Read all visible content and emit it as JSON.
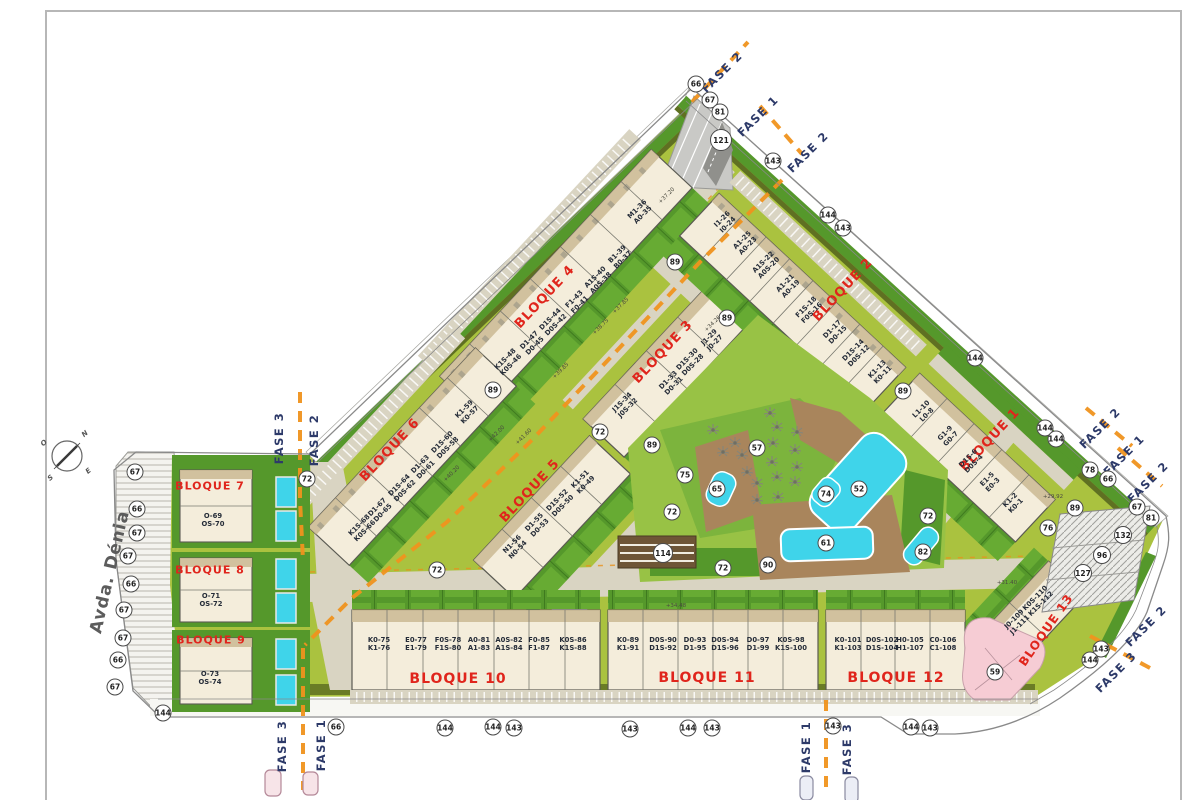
{
  "street": {
    "label": "Avda. Dénia"
  },
  "compass": {
    "n": "N",
    "o": "O",
    "s": "S",
    "e": "E"
  },
  "colors": {
    "block_red": "#e0251c",
    "fase_navy": "#2d3a69",
    "phase_orange": "#f0931e",
    "site_green": "#aac23f",
    "lawn_dark": "#55982b",
    "pool_cyan": "#3fd4ea",
    "building_cream": "#f4eddb",
    "deck_brown": "#a9855c",
    "pink_zone": "#f6ccd4"
  },
  "blocks": [
    {
      "label": "BLOQUE 1",
      "x": 990,
      "y": 440,
      "rot": -47,
      "fs": 13
    },
    {
      "label": "BLOQUE 2",
      "x": 843,
      "y": 290,
      "rot": -47,
      "fs": 13
    },
    {
      "label": "BLOQUE 3",
      "x": 663,
      "y": 352,
      "rot": -47,
      "fs": 13
    },
    {
      "label": "BLOQUE 4",
      "x": 545,
      "y": 297,
      "rot": -47,
      "fs": 13
    },
    {
      "label": "BLOQUE 5",
      "x": 530,
      "y": 491,
      "rot": -47,
      "fs": 13
    },
    {
      "label": "BLOQUE 6",
      "x": 390,
      "y": 450,
      "rot": -47,
      "fs": 13
    },
    {
      "label": "BLOQUE 7",
      "x": 210,
      "y": 486,
      "rot": 0,
      "fs": 11
    },
    {
      "label": "BLOQUE 8",
      "x": 210,
      "y": 570,
      "rot": 0,
      "fs": 11
    },
    {
      "label": "BLOQUE 9",
      "x": 211,
      "y": 640,
      "rot": 0,
      "fs": 11
    },
    {
      "label": "BLOQUE 10",
      "x": 458,
      "y": 679,
      "rot": 0,
      "fs": 14
    },
    {
      "label": "BLOQUE 11",
      "x": 707,
      "y": 678,
      "rot": 0,
      "fs": 14
    },
    {
      "label": "BLOQUE 12",
      "x": 896,
      "y": 678,
      "rot": 0,
      "fs": 14
    },
    {
      "label": "BLOQUE 13",
      "x": 1046,
      "y": 630,
      "rot": -55,
      "fs": 12
    }
  ],
  "units": [
    {
      "l1": "K1-2",
      "l2": "K0-1",
      "x": 1013,
      "y": 503,
      "rot": -45
    },
    {
      "l1": "E1-5",
      "l2": "E0-3",
      "x": 990,
      "y": 482,
      "rot": -45
    },
    {
      "l1": "D1S-6",
      "l2": "D0S-4",
      "x": 971,
      "y": 461,
      "rot": -45
    },
    {
      "l1": "G1-9",
      "l2": "G0-7",
      "x": 948,
      "y": 436,
      "rot": -45
    },
    {
      "l1": "L1-10",
      "l2": "L0-8",
      "x": 924,
      "y": 412,
      "rot": -45
    },
    {
      "l1": "K1-13",
      "l2": "K0-11",
      "x": 880,
      "y": 372,
      "rot": -45
    },
    {
      "l1": "D1S-14",
      "l2": "D0S-12",
      "x": 856,
      "y": 353,
      "rot": -45
    },
    {
      "l1": "D1-17",
      "l2": "D0-15",
      "x": 835,
      "y": 332,
      "rot": -45
    },
    {
      "l1": "F1S-18",
      "l2": "F0S-16",
      "x": 809,
      "y": 310,
      "rot": -45
    },
    {
      "l1": "A1-21",
      "l2": "A0-19",
      "x": 788,
      "y": 286,
      "rot": -45
    },
    {
      "l1": "A1S-22",
      "l2": "A0S-20",
      "x": 766,
      "y": 265,
      "rot": -45
    },
    {
      "l1": "A1-25",
      "l2": "A0-23",
      "x": 745,
      "y": 243,
      "rot": -45
    },
    {
      "l1": "I1-26",
      "l2": "I0-24",
      "x": 725,
      "y": 222,
      "rot": -45
    },
    {
      "l1": "J1S-34",
      "l2": "J0S-32",
      "x": 625,
      "y": 405,
      "rot": -45
    },
    {
      "l1": "D1-33",
      "l2": "D0-31",
      "x": 671,
      "y": 383,
      "rot": -45
    },
    {
      "l1": "D1S-30",
      "l2": "D0S-28",
      "x": 690,
      "y": 362,
      "rot": -45
    },
    {
      "l1": "J1-29",
      "l2": "J0-27",
      "x": 712,
      "y": 340,
      "rot": -45
    },
    {
      "l1": "K1S-48",
      "l2": "K0S-46",
      "x": 508,
      "y": 362,
      "rot": -45
    },
    {
      "l1": "D1-47",
      "l2": "D0-45",
      "x": 532,
      "y": 343,
      "rot": -45
    },
    {
      "l1": "D1S-44",
      "l2": "D0S-42",
      "x": 553,
      "y": 322,
      "rot": -45
    },
    {
      "l1": "F1-43",
      "l2": "F0-41",
      "x": 577,
      "y": 302,
      "rot": -45
    },
    {
      "l1": "A1S-40",
      "l2": "A0S-38",
      "x": 598,
      "y": 280,
      "rot": -45
    },
    {
      "l1": "B1-39",
      "l2": "B0-37",
      "x": 620,
      "y": 257,
      "rot": -45
    },
    {
      "l1": "M1-36",
      "l2": "A0-35",
      "x": 640,
      "y": 212,
      "rot": -45
    },
    {
      "l1": "N1-56",
      "l2": "N0-54",
      "x": 515,
      "y": 547,
      "rot": -45
    },
    {
      "l1": "D1-55",
      "l2": "D0-53",
      "x": 537,
      "y": 525,
      "rot": -45
    },
    {
      "l1": "D1S-52",
      "l2": "D0S-50",
      "x": 560,
      "y": 503,
      "rot": -45
    },
    {
      "l1": "K1-51",
      "l2": "K0-49",
      "x": 583,
      "y": 482,
      "rot": -45
    },
    {
      "l1": "K1S-68",
      "l2": "K0S-66",
      "x": 362,
      "y": 528,
      "rot": -45
    },
    {
      "l1": "D1-67",
      "l2": "D0-65",
      "x": 380,
      "y": 510,
      "rot": -45
    },
    {
      "l1": "D1S-64",
      "l2": "D0S-62",
      "x": 402,
      "y": 488,
      "rot": -45
    },
    {
      "l1": "D1-63",
      "l2": "D0-61",
      "x": 423,
      "y": 467,
      "rot": -45
    },
    {
      "l1": "D1S-60",
      "l2": "D0S-58",
      "x": 445,
      "y": 445,
      "rot": -45
    },
    {
      "l1": "K1-59",
      "l2": "K0-57",
      "x": 467,
      "y": 412,
      "rot": -45
    },
    {
      "l1": "O-69",
      "l2": "OS-70",
      "x": 213,
      "y": 520,
      "rot": 0
    },
    {
      "l1": "O-71",
      "l2": "OS-72",
      "x": 211,
      "y": 600,
      "rot": 0
    },
    {
      "l1": "O-73",
      "l2": "OS-74",
      "x": 210,
      "y": 678,
      "rot": 0
    },
    {
      "l1": "K0-75",
      "l2": "K1-76",
      "x": 379,
      "y": 644,
      "rot": 0
    },
    {
      "l1": "E0-77",
      "l2": "E1-79",
      "x": 416,
      "y": 644,
      "rot": 0
    },
    {
      "l1": "F0S-78",
      "l2": "F1S-80",
      "x": 448,
      "y": 644,
      "rot": 0
    },
    {
      "l1": "A0-81",
      "l2": "A1-83",
      "x": 479,
      "y": 644,
      "rot": 0
    },
    {
      "l1": "A0S-82",
      "l2": "A1S-84",
      "x": 509,
      "y": 644,
      "rot": 0
    },
    {
      "l1": "F0-85",
      "l2": "F1-87",
      "x": 539,
      "y": 644,
      "rot": 0
    },
    {
      "l1": "K0S-86",
      "l2": "K1S-88",
      "x": 573,
      "y": 644,
      "rot": 0
    },
    {
      "l1": "K0-89",
      "l2": "K1-91",
      "x": 628,
      "y": 644,
      "rot": 0
    },
    {
      "l1": "D0S-90",
      "l2": "D1S-92",
      "x": 663,
      "y": 644,
      "rot": 0
    },
    {
      "l1": "D0-93",
      "l2": "D1-95",
      "x": 695,
      "y": 644,
      "rot": 0
    },
    {
      "l1": "D0S-94",
      "l2": "D1S-96",
      "x": 725,
      "y": 644,
      "rot": 0
    },
    {
      "l1": "D0-97",
      "l2": "D1-99",
      "x": 758,
      "y": 644,
      "rot": 0
    },
    {
      "l1": "K0S-98",
      "l2": "K1S-100",
      "x": 791,
      "y": 644,
      "rot": 0
    },
    {
      "l1": "K0-101",
      "l2": "K1-103",
      "x": 848,
      "y": 644,
      "rot": 0
    },
    {
      "l1": "D0S-102",
      "l2": "D1S-104",
      "x": 882,
      "y": 644,
      "rot": 0
    },
    {
      "l1": "H0-105",
      "l2": "H1-107",
      "x": 910,
      "y": 644,
      "rot": 0
    },
    {
      "l1": "C0-106",
      "l2": "C1-108",
      "x": 943,
      "y": 644,
      "rot": 0
    },
    {
      "l1": "J0-109",
      "l2": "J1-111",
      "x": 1017,
      "y": 622,
      "rot": -45
    },
    {
      "l1": "K0S-110",
      "l2": "K1S-112",
      "x": 1038,
      "y": 601,
      "rot": -45
    }
  ],
  "fase_labels": [
    {
      "text": "FASE 2",
      "x": 722,
      "y": 72,
      "rot": -45
    },
    {
      "text": "FASE 1",
      "x": 758,
      "y": 116,
      "rot": -45
    },
    {
      "text": "FASE 2",
      "x": 808,
      "y": 152,
      "rot": -45
    },
    {
      "text": "FASE 2",
      "x": 1100,
      "y": 428,
      "rot": -45
    },
    {
      "text": "FASE 1",
      "x": 1124,
      "y": 455,
      "rot": -45
    },
    {
      "text": "FASE 2",
      "x": 1148,
      "y": 482,
      "rot": -45
    },
    {
      "text": "FASE 2",
      "x": 1146,
      "y": 626,
      "rot": -45
    },
    {
      "text": "FASE 3",
      "x": 1116,
      "y": 672,
      "rot": -45
    },
    {
      "text": "FASE 3",
      "x": 279,
      "y": 438,
      "rot": -90
    },
    {
      "text": "FASE 2",
      "x": 314,
      "y": 440,
      "rot": -90
    },
    {
      "text": "FASE 3",
      "x": 282,
      "y": 746,
      "rot": -90
    },
    {
      "text": "FASE 1",
      "x": 321,
      "y": 745,
      "rot": -90
    },
    {
      "text": "FASE 1",
      "x": 806,
      "y": 747,
      "rot": -90
    },
    {
      "text": "FASE 3",
      "x": 847,
      "y": 749,
      "rot": -90
    }
  ],
  "circles": [
    {
      "n": "66",
      "x": 696,
      "y": 84
    },
    {
      "n": "67",
      "x": 710,
      "y": 100
    },
    {
      "n": "81",
      "x": 720,
      "y": 112
    },
    {
      "n": "121",
      "x": 721,
      "y": 140,
      "d": 22
    },
    {
      "n": "143",
      "x": 773,
      "y": 161
    },
    {
      "n": "144",
      "x": 828,
      "y": 215
    },
    {
      "n": "143",
      "x": 843,
      "y": 228
    },
    {
      "n": "89",
      "x": 675,
      "y": 262
    },
    {
      "n": "89",
      "x": 727,
      "y": 318
    },
    {
      "n": "89",
      "x": 493,
      "y": 390
    },
    {
      "n": "72",
      "x": 307,
      "y": 479
    },
    {
      "n": "72",
      "x": 437,
      "y": 570
    },
    {
      "n": "72",
      "x": 600,
      "y": 432
    },
    {
      "n": "89",
      "x": 652,
      "y": 445
    },
    {
      "n": "75",
      "x": 685,
      "y": 475
    },
    {
      "n": "72",
      "x": 672,
      "y": 512
    },
    {
      "n": "114",
      "x": 663,
      "y": 553,
      "d": 20
    },
    {
      "n": "57",
      "x": 757,
      "y": 448
    },
    {
      "n": "65",
      "x": 717,
      "y": 489
    },
    {
      "n": "74",
      "x": 826,
      "y": 494
    },
    {
      "n": "52",
      "x": 859,
      "y": 489
    },
    {
      "n": "61",
      "x": 826,
      "y": 543
    },
    {
      "n": "90",
      "x": 768,
      "y": 565
    },
    {
      "n": "72",
      "x": 723,
      "y": 568
    },
    {
      "n": "82",
      "x": 923,
      "y": 552
    },
    {
      "n": "72",
      "x": 928,
      "y": 516
    },
    {
      "n": "144",
      "x": 975,
      "y": 358
    },
    {
      "n": "89",
      "x": 903,
      "y": 391
    },
    {
      "n": "144",
      "x": 1045,
      "y": 428
    },
    {
      "n": "144",
      "x": 1056,
      "y": 439
    },
    {
      "n": "78",
      "x": 1090,
      "y": 470
    },
    {
      "n": "66",
      "x": 1108,
      "y": 479
    },
    {
      "n": "89",
      "x": 1075,
      "y": 508
    },
    {
      "n": "76",
      "x": 1048,
      "y": 528
    },
    {
      "n": "67",
      "x": 1137,
      "y": 507
    },
    {
      "n": "81",
      "x": 1151,
      "y": 518
    },
    {
      "n": "132",
      "x": 1123,
      "y": 535,
      "d": 18
    },
    {
      "n": "96",
      "x": 1102,
      "y": 555,
      "d": 18
    },
    {
      "n": "127",
      "x": 1083,
      "y": 573,
      "d": 18
    },
    {
      "n": "59",
      "x": 995,
      "y": 672
    },
    {
      "n": "143",
      "x": 1101,
      "y": 649
    },
    {
      "n": "144",
      "x": 1090,
      "y": 660
    },
    {
      "n": "67",
      "x": 135,
      "y": 472
    },
    {
      "n": "66",
      "x": 137,
      "y": 509
    },
    {
      "n": "67",
      "x": 137,
      "y": 533
    },
    {
      "n": "67",
      "x": 128,
      "y": 556
    },
    {
      "n": "66",
      "x": 131,
      "y": 584
    },
    {
      "n": "67",
      "x": 124,
      "y": 610
    },
    {
      "n": "67",
      "x": 123,
      "y": 638
    },
    {
      "n": "66",
      "x": 118,
      "y": 660
    },
    {
      "n": "67",
      "x": 115,
      "y": 687
    },
    {
      "n": "144",
      "x": 163,
      "y": 713
    },
    {
      "n": "66",
      "x": 336,
      "y": 727
    },
    {
      "n": "144",
      "x": 445,
      "y": 728
    },
    {
      "n": "144",
      "x": 493,
      "y": 727
    },
    {
      "n": "143",
      "x": 514,
      "y": 728
    },
    {
      "n": "143",
      "x": 630,
      "y": 729
    },
    {
      "n": "144",
      "x": 688,
      "y": 728
    },
    {
      "n": "143",
      "x": 712,
      "y": 728
    },
    {
      "n": "143",
      "x": 833,
      "y": 726
    },
    {
      "n": "144",
      "x": 911,
      "y": 727
    },
    {
      "n": "143",
      "x": 930,
      "y": 728
    }
  ],
  "elevations": [
    {
      "t": "+37.20",
      "x": 667,
      "y": 196,
      "rot": -45
    },
    {
      "t": "+37.85",
      "x": 621,
      "y": 306,
      "rot": -45
    },
    {
      "t": "+38.75",
      "x": 601,
      "y": 327,
      "rot": -45
    },
    {
      "t": "+39.85",
      "x": 561,
      "y": 371,
      "rot": -45
    },
    {
      "t": "+42.00",
      "x": 497,
      "y": 434,
      "rot": -45
    },
    {
      "t": "+41.60",
      "x": 524,
      "y": 437,
      "rot": -45
    },
    {
      "t": "+40.20",
      "x": 452,
      "y": 474,
      "rot": -45
    },
    {
      "t": "+34.26",
      "x": 713,
      "y": 324,
      "rot": -45
    },
    {
      "t": "+34.48",
      "x": 676,
      "y": 606,
      "rot": 0
    },
    {
      "t": "+31.40",
      "x": 1007,
      "y": 583,
      "rot": 0
    },
    {
      "t": "+29.92",
      "x": 1053,
      "y": 497,
      "rot": 0
    }
  ]
}
